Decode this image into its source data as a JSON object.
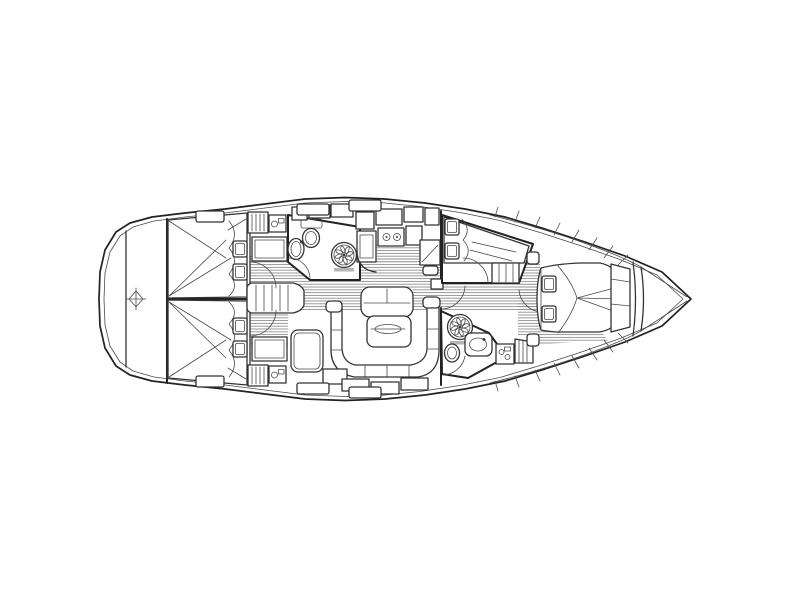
{
  "diagram": {
    "kind": "sailing-yacht-interior-floor-plan",
    "aria_label": "Sailing yacht interior layout floor plan, bow to the right, stern to the left",
    "orientation": {
      "bow": "right",
      "stern": "left"
    },
    "colors": {
      "background": "#ffffff",
      "outline": "#222222",
      "detail": "#3a3a3a",
      "floor_hatch": "#8f8f8f",
      "label_bar": "#b5b5b5"
    },
    "rooms": [
      {
        "id": "stern-platform",
        "name": "Stern transom and swim platform",
        "fixtures": [
          "centre-marker"
        ]
      },
      {
        "id": "aft-cabin-top",
        "name": "Aft double cabin (upper)",
        "fixtures": [
          "double-berth",
          "two-pillows",
          "duvet-scallop",
          "wardrobe",
          "louvered-locker"
        ]
      },
      {
        "id": "aft-cabin-bottom",
        "name": "Aft double cabin (lower)",
        "fixtures": [
          "double-berth",
          "two-pillows",
          "duvet-scallop",
          "wardrobe",
          "louvered-locker"
        ]
      },
      {
        "id": "companionway",
        "name": "Companionway steps",
        "fixtures": [
          "five-rung-ladder"
        ]
      },
      {
        "id": "aft-head",
        "name": "Aft head (upper)",
        "fixtures": [
          "toilet",
          "washbasin",
          "shower-rose"
        ]
      },
      {
        "id": "galley",
        "name": "Galley",
        "fixtures": [
          "two-burner-stove",
          "sink",
          "overhead-lockers",
          "corner-counter"
        ]
      },
      {
        "id": "nav-station",
        "name": "Chart table with seat"
      },
      {
        "id": "saloon",
        "name": "Saloon",
        "fixtures": [
          "bench-seat",
          "folding-table-with-inlay",
          "u-shaped-settee",
          "side-seat",
          "hull-lockers"
        ]
      },
      {
        "id": "mid-cabin",
        "name": "Midship side cabin (upper)",
        "fixtures": [
          "double-berth",
          "two-pillows",
          "dresser"
        ]
      },
      {
        "id": "forward-head",
        "name": "Forward head (lower)",
        "fixtures": [
          "toilet",
          "washbasin",
          "shower-rose",
          "vanity-locker",
          "louvered-locker"
        ]
      },
      {
        "id": "passageway",
        "name": "Passageway to forward cabin"
      },
      {
        "id": "forward-cabin",
        "name": "Forward owner cabin",
        "fixtures": [
          "island-double-berth",
          "two-pillows",
          "duvet-scallop",
          "nightstands",
          "hull-shelves"
        ]
      },
      {
        "id": "bow",
        "name": "Bow with anchor locker",
        "fixtures": [
          "chain-locker-shelves"
        ]
      }
    ],
    "counts": {
      "cabins": 4,
      "heads": 2,
      "pillows": 8,
      "shower_roses": 2,
      "companionway_rungs": 5
    }
  }
}
